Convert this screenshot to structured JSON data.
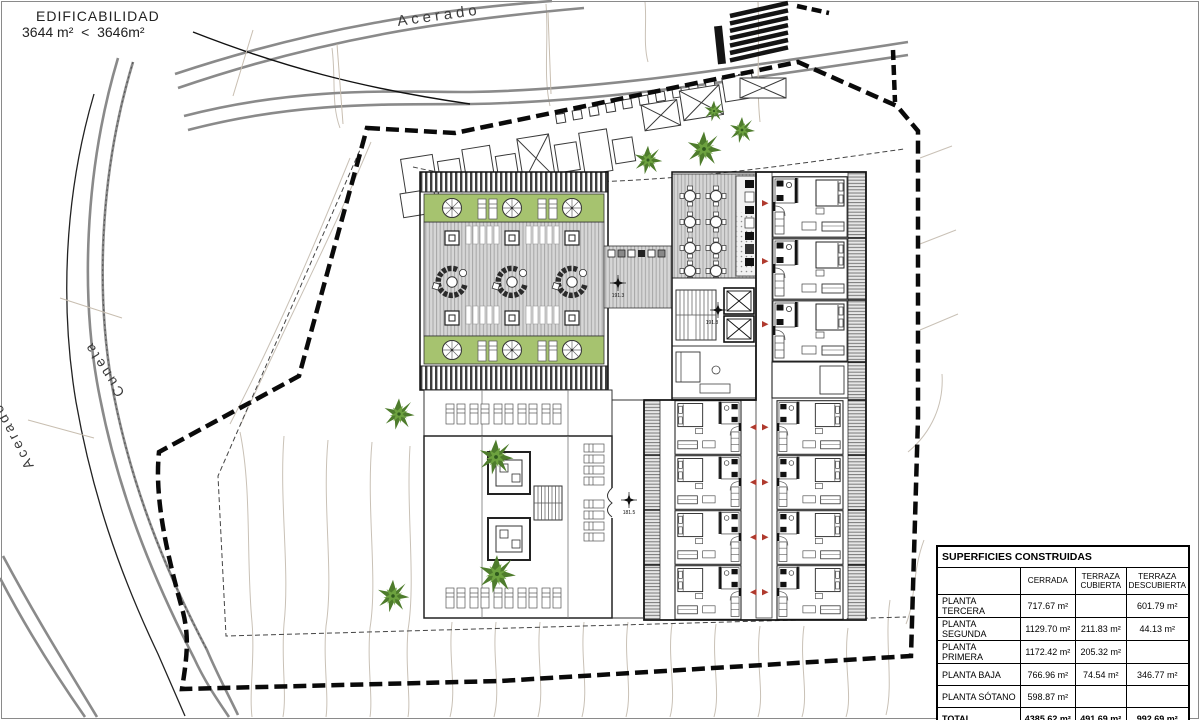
{
  "colors": {
    "green": "#a6c36f",
    "deck_gray": "#d6d6d6",
    "road_gray": "#8a8a8a",
    "contour_tan": "#c9c1b6",
    "boundary_black": "#0a0a0a",
    "tree_green_dark": "#4e7c2c",
    "tree_green_light": "#6da23f",
    "door_arrow_red": "#b03a2e"
  },
  "edificability": {
    "title": "EDIFICABILIDAD",
    "comparison": "3644 m²  <  3646m²"
  },
  "road_labels": {
    "top": "Acerado",
    "left": "Cuneta",
    "bottom_left": "Acerado"
  },
  "elevation_markers": [
    {
      "label": "191.3"
    },
    {
      "label": "191.3"
    },
    {
      "label": "181.5"
    }
  ],
  "areas_table": {
    "title": "SUPERFICIES CONSTRUIDAS",
    "columns": [
      "",
      "CERRADA",
      "TERRAZA CUBIERTA",
      "TERRAZA DESCUBIERTA"
    ],
    "rows": [
      {
        "name": "PLANTA TERCERA",
        "cerrada": "717.67 m²",
        "terraza_cubierta": "",
        "terraza_descubierta": "601.79 m²"
      },
      {
        "name": "PLANTA SEGUNDA",
        "cerrada": "1129.70 m²",
        "terraza_cubierta": "211.83 m²",
        "terraza_descubierta": "44.13 m²"
      },
      {
        "name": "PLANTA PRIMERA",
        "cerrada": "1172.42 m²",
        "terraza_cubierta": "205.32 m²",
        "terraza_descubierta": ""
      },
      {
        "name": "PLANTA BAJA",
        "cerrada": "766.96 m²",
        "terraza_cubierta": "74.54 m²",
        "terraza_descubierta": "346.77 m²"
      },
      {
        "name": "PLANTA SÓTANO",
        "cerrada": "598.87 m²",
        "terraza_cubierta": "",
        "terraza_descubierta": ""
      },
      {
        "name": "TOTAL",
        "cerrada": "4385.62 m²",
        "terraza_cubierta": "491.69 m²",
        "terraza_descubierta": "992.69 m²"
      }
    ]
  }
}
